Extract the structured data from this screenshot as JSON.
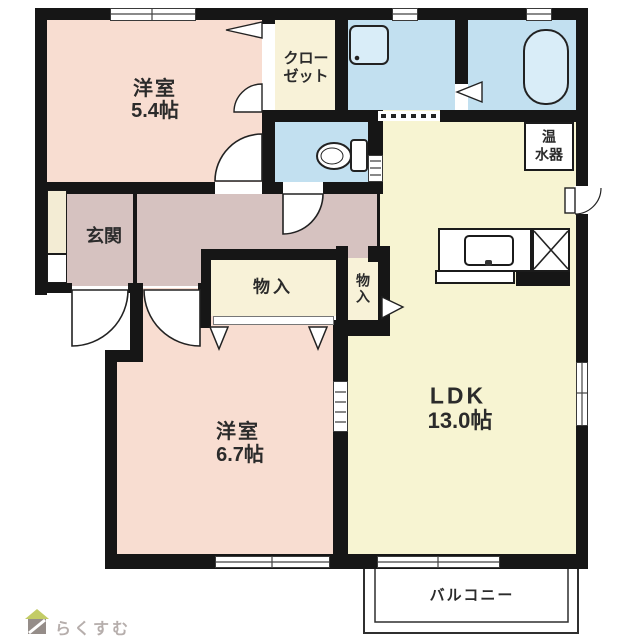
{
  "plan": {
    "rooms": {
      "bedroom1": {
        "name": "洋室",
        "size": "5.4帖"
      },
      "closet": {
        "line1": "クロー",
        "line2": "ゼット"
      },
      "genkan": {
        "name": "玄関"
      },
      "storage1": {
        "name": "物入"
      },
      "storage2": {
        "name": "物入"
      },
      "bedroom2": {
        "name": "洋室",
        "size": "6.7帖"
      },
      "ldk": {
        "name": "LDK",
        "size": "13.0帖"
      },
      "water_heater": {
        "line1": "温",
        "line2": "水器"
      },
      "balcony": {
        "name": "バルコニー"
      }
    }
  },
  "logo": {
    "text": "らくすむ"
  },
  "palette": {
    "room_pink": "#f8ddd1",
    "hall_mauve": "#d6c2c0",
    "cream_yellow": "#f8f2d8",
    "ldk_yellow": "#f7f4d2",
    "wet_area_blue": "#c2e0f0",
    "fixture_blue": "#d9edf8",
    "wall_black": "#161616",
    "logo_roof_green": "#c3cc66",
    "logo_gray": "#b6aeac"
  }
}
